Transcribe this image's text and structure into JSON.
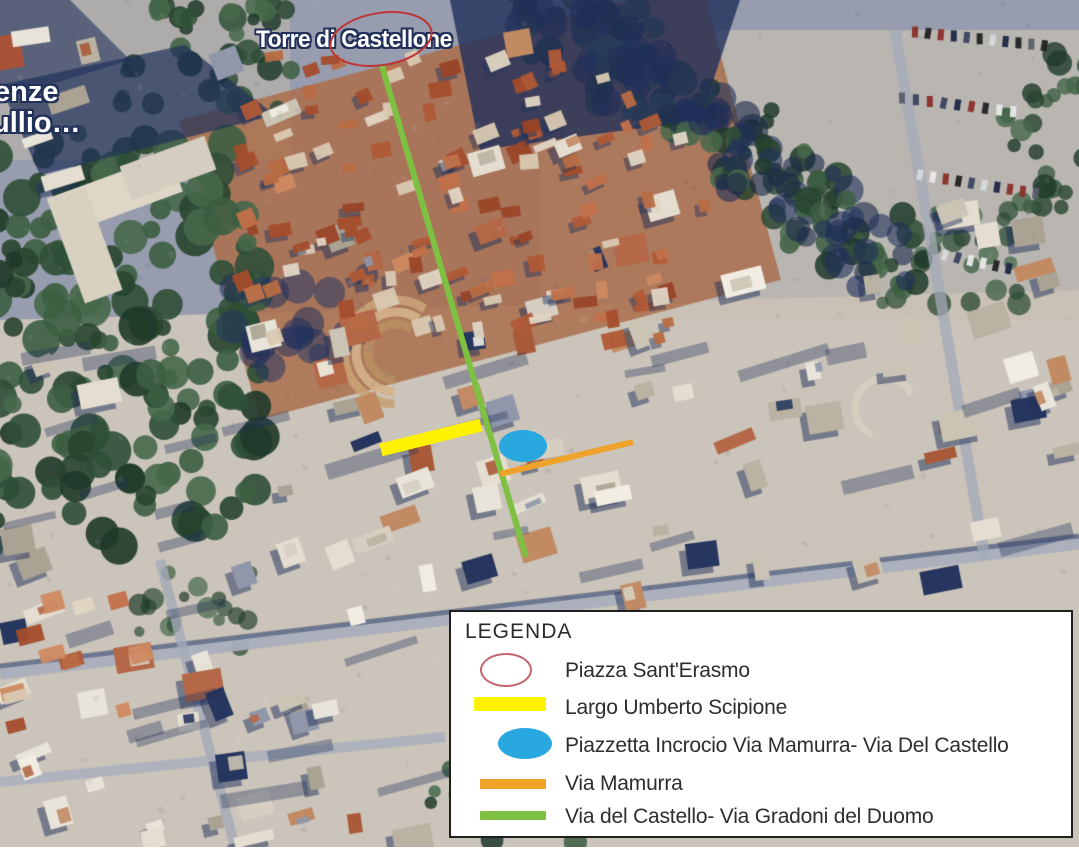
{
  "map": {
    "labels": {
      "torre": "Torre di Castellone",
      "partial_1": "enze",
      "partial_2": "ullio…"
    }
  },
  "colors": {
    "red_map": "#bf3434",
    "red_legend": "#c4646e",
    "yellow": "#fff200",
    "blue": "#29a8e0",
    "orange": "#f0a32a",
    "green": "#7ec142"
  },
  "legend": {
    "title": "LEGENDA",
    "items": [
      {
        "symbol": "red-ellipse-outline",
        "label": "Piazza Sant'Erasmo"
      },
      {
        "symbol": "yellow-bar",
        "label": "Largo Umberto Scipione"
      },
      {
        "symbol": "blue-ellipse",
        "label": "Piazzetta Incrocio Via Mamurra- Via Del Castello"
      },
      {
        "symbol": "orange-bar",
        "label": "Via Mamurra"
      },
      {
        "symbol": "green-bar",
        "label": "Via del Castello- Via Gradoni del Duomo"
      }
    ]
  }
}
